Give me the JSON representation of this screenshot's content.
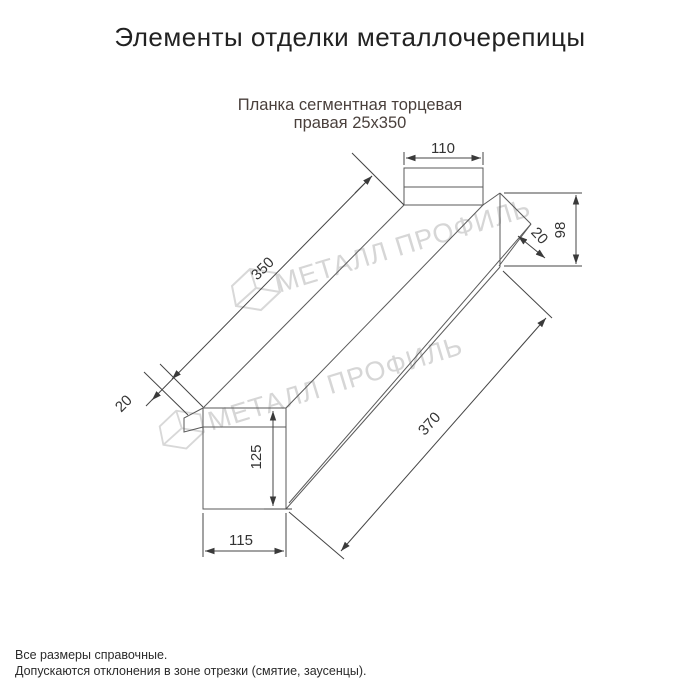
{
  "header": {
    "title": "Элементы отделки металлочерепицы"
  },
  "product": {
    "name_line1": "Планка сегментная торцевая",
    "name_line2": "правая 25х350"
  },
  "drawing": {
    "type": "technical-dimension-drawing",
    "dimensions": {
      "top_flange_width": "110",
      "right_end_height": "98",
      "right_hem": "20",
      "upper_length": "350",
      "left_hem": "20",
      "front_face_height": "125",
      "front_face_width": "115",
      "lower_length": "370"
    },
    "watermark_text": "МЕТАЛЛ ПРОФИЛЬ"
  },
  "footer": {
    "note1": "Все размеры справочные.",
    "note2": "Допускаются отклонения в зоне отрезки (смятие, заусенцы)."
  },
  "colors": {
    "title": "#222222",
    "subtitle": "#4a403c",
    "drawing_line": "#5a5a5a",
    "dimension_text": "#333333",
    "watermark": "#d6d6d6",
    "background": "#ffffff"
  }
}
